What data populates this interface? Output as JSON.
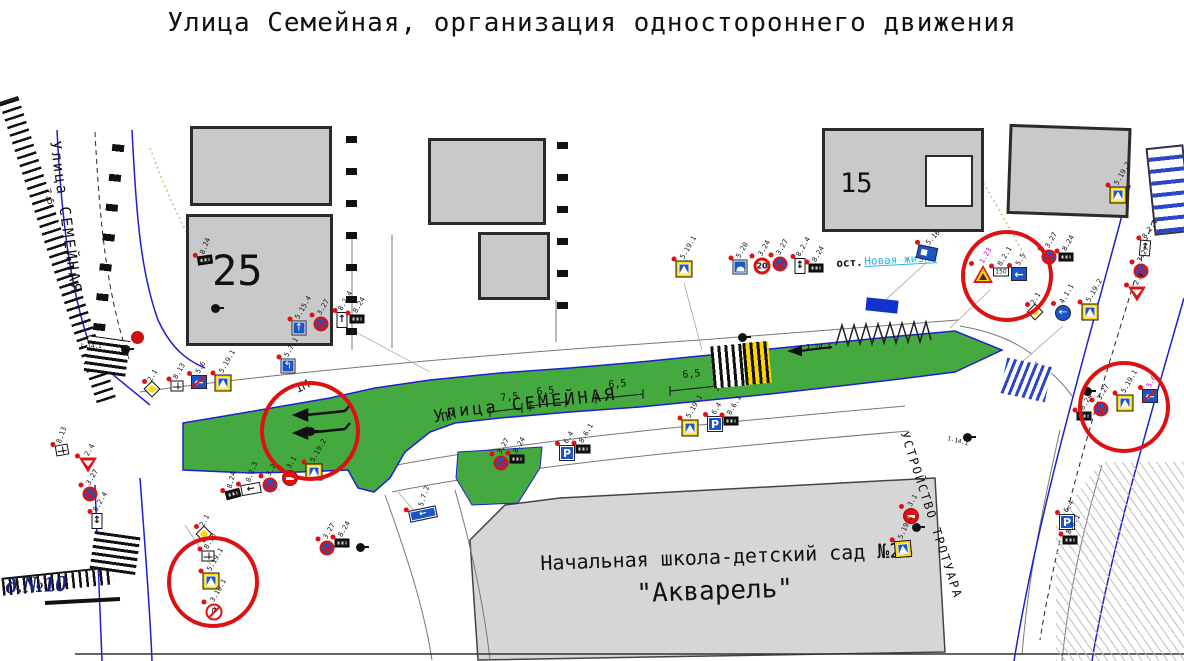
{
  "title": "Улица Семейная, организация одностороннего движения",
  "colors": {
    "road_green": "#44a93e",
    "edge_blue": "#1f1fd0",
    "highlight_red": "#dd1111",
    "sign_blue": "#1b55c8",
    "sign_yellow": "#ffd900",
    "building_gray": "#c9c9c9",
    "school_gray": "#d6d6d6",
    "bus_stop_link": "#29b5e6"
  },
  "glyphs": {
    "one-way": "←",
    "one-way-end": "←",
    "blue-arrow-circle": "←",
    "blue-lane": "↑",
    "blue-lane2": "↰",
    "plate-arrow-up": "↑",
    "plate-arrow-ud": "↕",
    "plate-arrow-left": "←",
    "blue-rect-arrow": "←",
    "no-right-turn": "↱"
  },
  "map": {
    "labels": [
      {
        "name": "street-left-label",
        "text": "Улица СЕМЕЙНАЯ",
        "x": 62,
        "y": 140,
        "rot": 82,
        "size": 15,
        "ls": 2
      },
      {
        "name": "dim-label",
        "text": "7.5",
        "x": 50,
        "y": 188,
        "rot": 75,
        "size": 9
      },
      {
        "name": "street-main-label",
        "text": "улица СЕМЕЙНАЯ",
        "x": 432,
        "y": 406,
        "rot": -6,
        "size": 17,
        "ls": 3
      },
      {
        "name": "building-25-number",
        "text": "25",
        "x": 212,
        "y": 250,
        "size": 42
      },
      {
        "name": "building-15-number",
        "text": "15",
        "x": 840,
        "y": 170,
        "size": 27
      },
      {
        "name": "house-10-label",
        "text": "д.№10",
        "x": 5,
        "y": 574,
        "rot": -2,
        "size": 23,
        "color": "#1a1f7a",
        "serif": 1,
        "b": 1
      },
      {
        "name": "school-name-line1",
        "text": "Начальная школа-детский сад №26",
        "x": 540,
        "y": 553,
        "rot": -2,
        "size": 20
      },
      {
        "name": "school-name-line2",
        "text": "\"Акварель\"",
        "x": 636,
        "y": 581,
        "rot": -2,
        "size": 26
      },
      {
        "name": "bus-stop-prefix",
        "text": "ост.",
        "x": 836,
        "y": 258,
        "rot": -3,
        "size": 11,
        "b": 1
      },
      {
        "name": "bus-stop-name",
        "text": "Новая жизнь",
        "x": 864,
        "y": 256,
        "rot": -3,
        "size": 11,
        "color": "#29b5e6",
        "u": 1
      },
      {
        "name": "sidewalk-works-label",
        "text": "УСТРОЙСТВО ТРОТУАРА",
        "x": 910,
        "y": 430,
        "rot": 72,
        "size": 12,
        "ls": 2
      },
      {
        "name": "dim-label",
        "text": "7,5",
        "x": 500,
        "y": 394,
        "rot": -6,
        "size": 10
      },
      {
        "name": "dim-label",
        "text": "6,5",
        "x": 536,
        "y": 388,
        "rot": -6,
        "size": 10
      },
      {
        "name": "dim-label",
        "text": "6,5",
        "x": 608,
        "y": 381,
        "rot": -6,
        "size": 10
      },
      {
        "name": "dim-label",
        "text": "6,5",
        "x": 682,
        "y": 371,
        "rot": -6,
        "size": 10
      },
      {
        "name": "marking-label",
        "text": "ПМ",
        "x": 440,
        "y": 412,
        "rot": -14,
        "size": 12
      },
      {
        "name": "marking-label",
        "text": "1М",
        "x": 293,
        "y": 384,
        "rot": -25,
        "size": 12
      },
      {
        "name": "marking-label",
        "text": "1.24.1",
        "x": 806,
        "y": 344,
        "size": 7
      },
      {
        "name": "marking-label",
        "text": "1.14.1",
        "x": 80,
        "y": 344,
        "size": 6
      },
      {
        "name": "marking-label",
        "text": "1.14.1",
        "x": 948,
        "y": 436,
        "rot": 15,
        "size": 6
      }
    ],
    "signs": [
      {
        "code": "8.13",
        "type": "plate-white",
        "x": 62,
        "y": 450,
        "rot": -10
      },
      {
        "code": "2.4",
        "type": "give-way",
        "x": 88,
        "y": 465
      },
      {
        "code": "3.27",
        "type": "no-stopping",
        "x": 90,
        "y": 494
      },
      {
        "code": "8.2.4",
        "type": "plate-arrow-ud",
        "x": 97,
        "y": 521
      },
      {
        "code": "2.1",
        "type": "priority",
        "x": 152,
        "y": 389
      },
      {
        "code": "8.13",
        "type": "plate-white",
        "x": 177,
        "y": 386
      },
      {
        "code": "5.6",
        "type": "one-way-end",
        "x": 199,
        "y": 382
      },
      {
        "code": "5.19.1",
        "type": "ped-crossing",
        "x": 223,
        "y": 383
      },
      {
        "code": "8.24",
        "type": "plate-dark",
        "x": 205,
        "y": 260,
        "rot": -8
      },
      {
        "code": "5.15.4",
        "type": "blue-lane",
        "x": 299,
        "y": 328
      },
      {
        "code": "3.27",
        "type": "no-stopping",
        "x": 321,
        "y": 324
      },
      {
        "code": "8.2.4",
        "type": "plate-arrow-up",
        "x": 342,
        "y": 320
      },
      {
        "code": "8.24",
        "type": "plate-dark",
        "x": 357,
        "y": 319
      },
      {
        "code": "5.7.1",
        "type": "blue-lane2",
        "x": 288,
        "y": 366
      },
      {
        "code": "8.24",
        "type": "plate-dark",
        "x": 233,
        "y": 494,
        "rot": -15
      },
      {
        "code": "8.2.3",
        "type": "plate-arrow-left",
        "x": 251,
        "y": 489,
        "rot": -10
      },
      {
        "code": "3.27",
        "type": "no-stopping",
        "x": 270,
        "y": 485
      },
      {
        "code": "3.1",
        "type": "no-entry",
        "x": 290,
        "y": 478
      },
      {
        "code": "5.19.2",
        "type": "ped-crossing",
        "x": 314,
        "y": 472
      },
      {
        "code": "3.27",
        "type": "no-stopping",
        "x": 327,
        "y": 548
      },
      {
        "code": "8.24",
        "type": "plate-dark",
        "x": 342,
        "y": 543
      },
      {
        "code": "5.7.2",
        "type": "blue-rect-arrow",
        "x": 423,
        "y": 514,
        "rot": -12
      },
      {
        "code": "3.27",
        "type": "no-stopping",
        "x": 501,
        "y": 463
      },
      {
        "code": "8.24",
        "type": "plate-dark",
        "x": 517,
        "y": 459
      },
      {
        "code": "6.4",
        "type": "parking",
        "text": "P",
        "x": 567,
        "y": 453
      },
      {
        "code": "8.6.1",
        "type": "plate-dark",
        "x": 583,
        "y": 449
      },
      {
        "code": "5.19.1",
        "type": "ped-crossing",
        "x": 690,
        "y": 428
      },
      {
        "code": "6.4",
        "type": "parking",
        "text": "P",
        "x": 715,
        "y": 424
      },
      {
        "code": "8.6.1",
        "type": "plate-dark",
        "x": 731,
        "y": 421
      },
      {
        "code": "5.19.1",
        "type": "ped-crossing",
        "x": 684,
        "y": 269
      },
      {
        "code": "5.20",
        "type": "blue-hump",
        "x": 740,
        "y": 267
      },
      {
        "code": "3.24",
        "type": "speed-limit",
        "text": "20",
        "x": 762,
        "y": 266
      },
      {
        "code": "3.27",
        "type": "no-stopping",
        "x": 780,
        "y": 264
      },
      {
        "code": "8.2.4",
        "type": "plate-arrow-ud",
        "x": 800,
        "y": 266
      },
      {
        "code": "8.24",
        "type": "plate-dark",
        "x": 816,
        "y": 268
      },
      {
        "code": "5.16",
        "type": "bus-stop",
        "x": 927,
        "y": 253,
        "rot": 12
      },
      {
        "code": "1.23",
        "type": "children",
        "x": 983,
        "y": 274,
        "lc": "#cc00cc"
      },
      {
        "code": "8.2.1",
        "type": "plate-150",
        "text": "150",
        "x": 1001,
        "y": 272
      },
      {
        "code": "5.5",
        "type": "one-way",
        "x": 1019,
        "y": 274
      },
      {
        "code": "3.27",
        "type": "no-stopping",
        "x": 1049,
        "y": 257
      },
      {
        "code": "8.24",
        "type": "plate-dark",
        "x": 1066,
        "y": 257
      },
      {
        "code": "2.1",
        "type": "priority",
        "x": 1035,
        "y": 312
      },
      {
        "code": "4.1.1",
        "type": "blue-arrow-circle",
        "x": 1063,
        "y": 313
      },
      {
        "code": "5.19.2",
        "type": "ped-crossing",
        "x": 1090,
        "y": 312
      },
      {
        "code": "5.19.2",
        "type": "ped-crossing",
        "x": 1118,
        "y": 195
      },
      {
        "code": "8.2.4",
        "type": "plate-arrow-up",
        "x": 1145,
        "y": 248,
        "rot": 5
      },
      {
        "code": "3.27",
        "type": "no-stopping",
        "x": 1141,
        "y": 271
      },
      {
        "code": "2.4",
        "type": "give-way",
        "x": 1137,
        "y": 294
      },
      {
        "code": "3.27",
        "type": "no-stopping",
        "x": 1101,
        "y": 409
      },
      {
        "code": "5.19.1",
        "type": "ped-crossing",
        "x": 1125,
        "y": 403
      },
      {
        "code": "5.6",
        "type": "one-way-end",
        "x": 1150,
        "y": 396,
        "lc": "#cc00cc"
      },
      {
        "code": "8.24",
        "type": "plate-dark",
        "x": 1084,
        "y": 416
      },
      {
        "code": "2.1",
        "type": "priority",
        "x": 204,
        "y": 534
      },
      {
        "code": "8.13",
        "type": "plate-white",
        "x": 208,
        "y": 556
      },
      {
        "code": "5.19.1",
        "type": "ped-crossing",
        "x": 211,
        "y": 581
      },
      {
        "code": "3.18.1",
        "type": "no-right-turn",
        "x": 214,
        "y": 612
      },
      {
        "code": "3.1",
        "type": "no-entry",
        "x": 911,
        "y": 516
      },
      {
        "code": "5.19.1",
        "type": "ped-crossing",
        "x": 903,
        "y": 549,
        "rot": -5
      },
      {
        "code": "6.4",
        "type": "parking",
        "text": "P",
        "x": 1067,
        "y": 522
      },
      {
        "code": "8.6.1",
        "type": "plate-dark",
        "x": 1070,
        "y": 540
      }
    ],
    "highlight_circles": [
      {
        "x": 310,
        "y": 431,
        "r": 46
      },
      {
        "x": 1007,
        "y": 276,
        "r": 42
      },
      {
        "x": 1124,
        "y": 407,
        "r": 42
      },
      {
        "x": 213,
        "y": 582,
        "r": 42
      }
    ],
    "street_lights": [
      {
        "x": 125,
        "y": 349
      },
      {
        "x": 215,
        "y": 308
      },
      {
        "x": 310,
        "y": 431
      },
      {
        "x": 360,
        "y": 547
      },
      {
        "x": 742,
        "y": 337
      },
      {
        "x": 916,
        "y": 527
      },
      {
        "x": 967,
        "y": 437
      },
      {
        "x": 1087,
        "y": 391
      }
    ]
  }
}
